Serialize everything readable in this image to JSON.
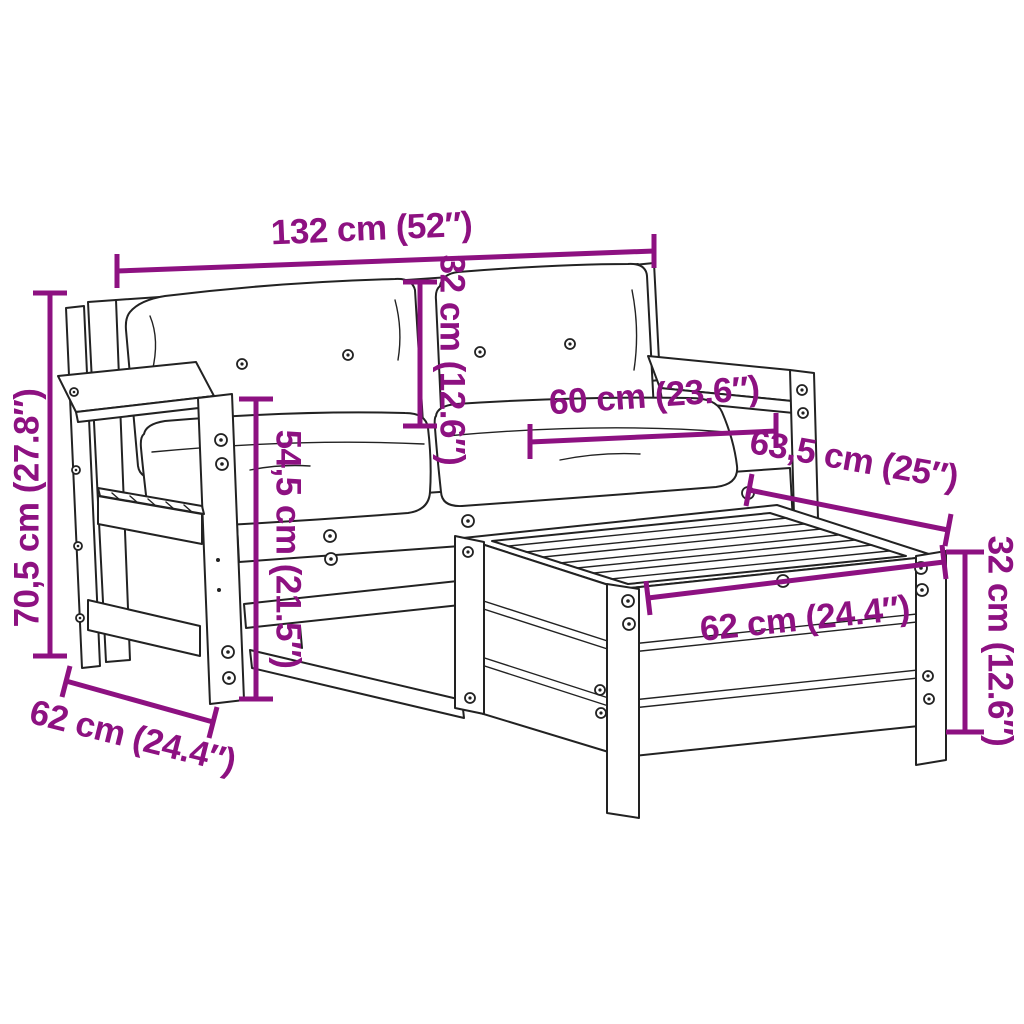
{
  "page": {
    "background": "#ffffff"
  },
  "style": {
    "dimension_color": "#8D1181",
    "line_color": "#222222"
  },
  "product": {
    "name": "garden-sofa-set-with-footstool-dimension-diagram"
  },
  "dims": {
    "total_width": {
      "label": "132 cm (52″)"
    },
    "back_cushion_height": {
      "label": "32 cm (12.6″)"
    },
    "seat_width": {
      "label": "60 cm (23.6″)"
    },
    "table_depth_diagonal": {
      "label": "63,5 cm (25″)"
    },
    "total_height": {
      "label": "70,5 cm (27.8″)"
    },
    "seat_side_height": {
      "label": "54,5 cm (21.5″)"
    },
    "sofa_depth": {
      "label": "62 cm (24.4″)"
    },
    "table_width": {
      "label": "62 cm (24.4″)"
    },
    "table_height": {
      "label": "32 cm (12.6″)"
    }
  }
}
